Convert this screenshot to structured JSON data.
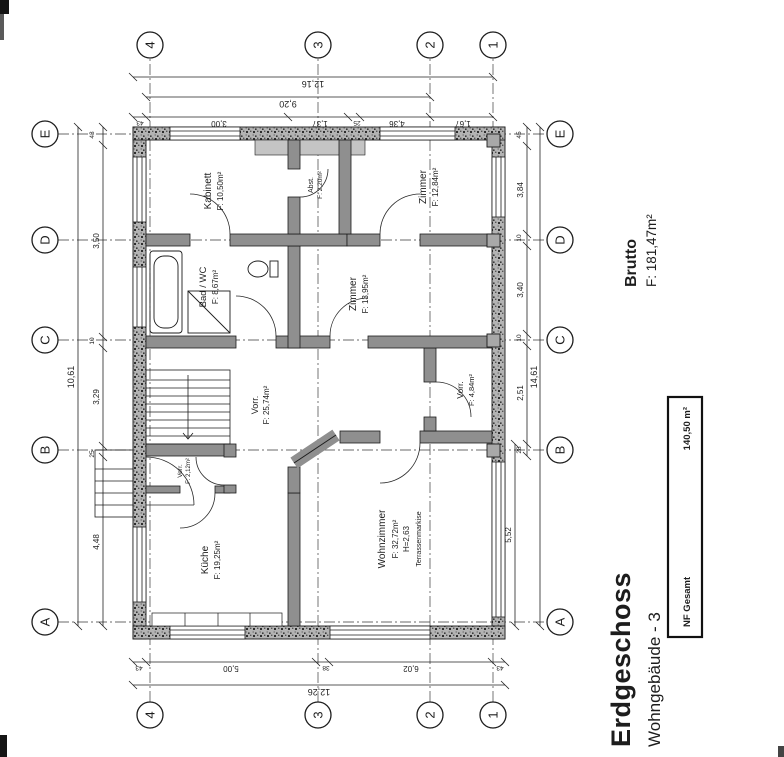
{
  "title": {
    "main": "Erdgeschoss",
    "sub": "Wohngebäude - 3"
  },
  "summary": {
    "brutto_label": "Brutto",
    "brutto_area": "F: 181,47m²",
    "nf_label": "NF Gesamt",
    "nf_value": "140,50 m²"
  },
  "grid": {
    "letters": [
      "A",
      "B",
      "C",
      "D",
      "E"
    ],
    "numbers": [
      "4",
      "3",
      "2",
      "1"
    ]
  },
  "rooms": {
    "kueche": {
      "name": "Küche",
      "area": "F: 19,25m²"
    },
    "wohnzimmer": {
      "name": "Wohnzimmer",
      "area": "F: 32,72m²",
      "height": "H=2,63",
      "note": "Terrassenmarkise"
    },
    "vorraum_gross": {
      "name": "Vorr.",
      "area": "F: 25,74m²"
    },
    "vorraum_klein": {
      "name": "Vorr.",
      "area": "F: 2,12m²"
    },
    "vorraum_sued": {
      "name": "Vorr.",
      "area": "F: 4,84m²"
    },
    "bad_wc": {
      "name": "Bad / WC",
      "area": "F: 8,67m²"
    },
    "kabinett": {
      "name": "Kabinett",
      "area": "F: 10,50m²"
    },
    "abstellraum": {
      "name": "Abst.",
      "area": "F: 2,20m²"
    },
    "zimmer_1": {
      "name": "Zimmer",
      "area": "F: 13,95m²"
    },
    "zimmer_2": {
      "name": "Zimmer",
      "area": "F: 12,84m²"
    }
  },
  "dimensions": {
    "top": {
      "overall": "10,61",
      "segments": [
        "4,48",
        "25",
        "3,29",
        "10",
        "3,50",
        "43"
      ]
    },
    "bottom": {
      "overall": "14,61",
      "inner": "5,52",
      "segments": [
        "28",
        "2,51",
        "10",
        "3,40",
        "10",
        "3,84",
        "45"
      ]
    },
    "left": {
      "overall": "12,26",
      "segments": [
        "43",
        "5,00",
        "38",
        "6,02",
        "43"
      ]
    },
    "right": {
      "overall": "12,16",
      "span": "9,20",
      "segments": [
        "43",
        "3,00",
        "1,37",
        "25",
        "4,36",
        "1,67"
      ]
    }
  },
  "colors": {
    "ink": "#1d1d1d",
    "wall_exterior": "#b3b3b3",
    "wall_interior": "#8f8f8f",
    "paper": "#ffffff"
  }
}
